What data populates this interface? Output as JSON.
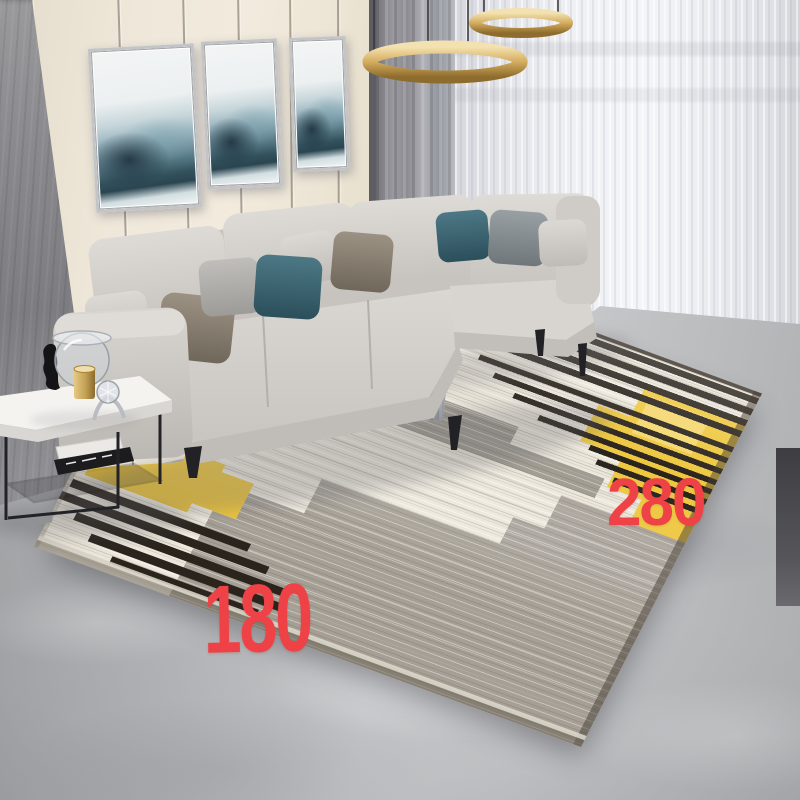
{
  "scene": {
    "description": "Living room product photo of a modern striped area rug with yellow color blocks",
    "elements": [
      "panel wall with three abstract paintings",
      "gold ring pendant light",
      "gray and sheer curtains",
      "light gray L-shaped sectional sofa with pillows",
      "white side table with glass decor and books",
      "striped area rug",
      "concrete floor"
    ]
  },
  "dimension_labels": {
    "width_label": "180",
    "length_label": "280",
    "label_color": "#ee4247"
  },
  "palette": {
    "wall_cream": "#efe8da",
    "accent_wall_gray": "#87878c",
    "curtain_gray": "#9b9ba1",
    "curtain_sheer": "#eff0f4",
    "pendant_gold": "#d4ac5e",
    "sofa_gray": "#d3d0cb",
    "pillow_teal": "#3a6672",
    "pillow_taupe": "#8d8477",
    "pillow_slate": "#868e92",
    "rug_cream": "#ece7db",
    "rug_gray": "#a09a90",
    "rug_yellow": "#edc63e",
    "rug_stripe_black": "#272019",
    "floor_concrete": "#bfc0c2",
    "table_white": "#f4f3f0",
    "table_frame_black": "#232327"
  }
}
